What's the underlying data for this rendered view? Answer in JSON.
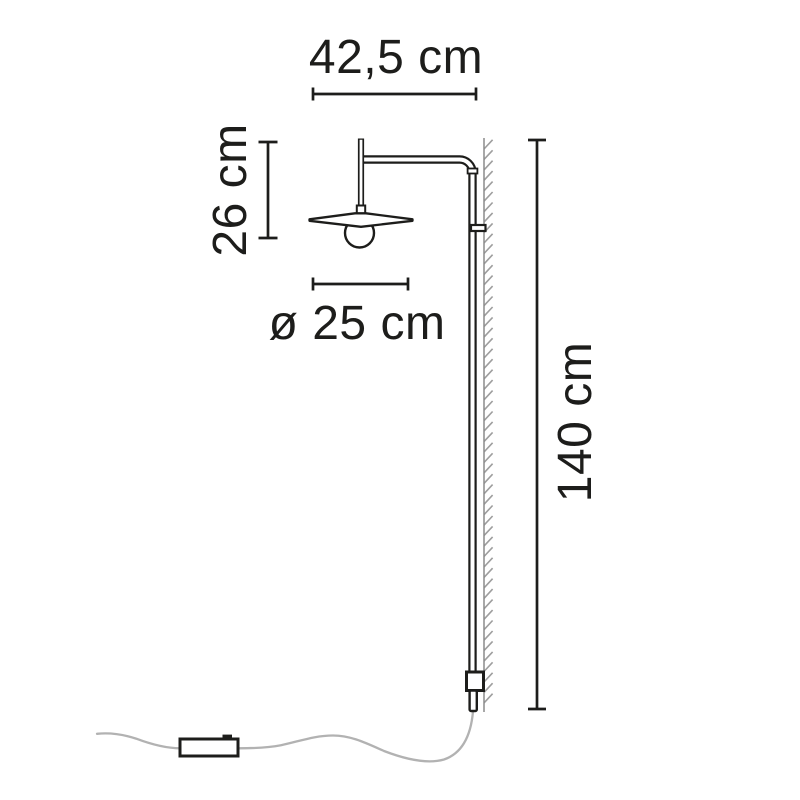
{
  "labels": {
    "arm_width": "42,5 cm",
    "head_drop": "26 cm",
    "shade_diameter": "ø 25 cm",
    "total_height": "140 cm"
  },
  "colors": {
    "line": "#1d1d1b",
    "text": "#1d1d1b",
    "cord": "#b2b2b2",
    "wall": "#8c8c8c",
    "hatch": "#9e9e9e",
    "background": "#ffffff"
  }
}
